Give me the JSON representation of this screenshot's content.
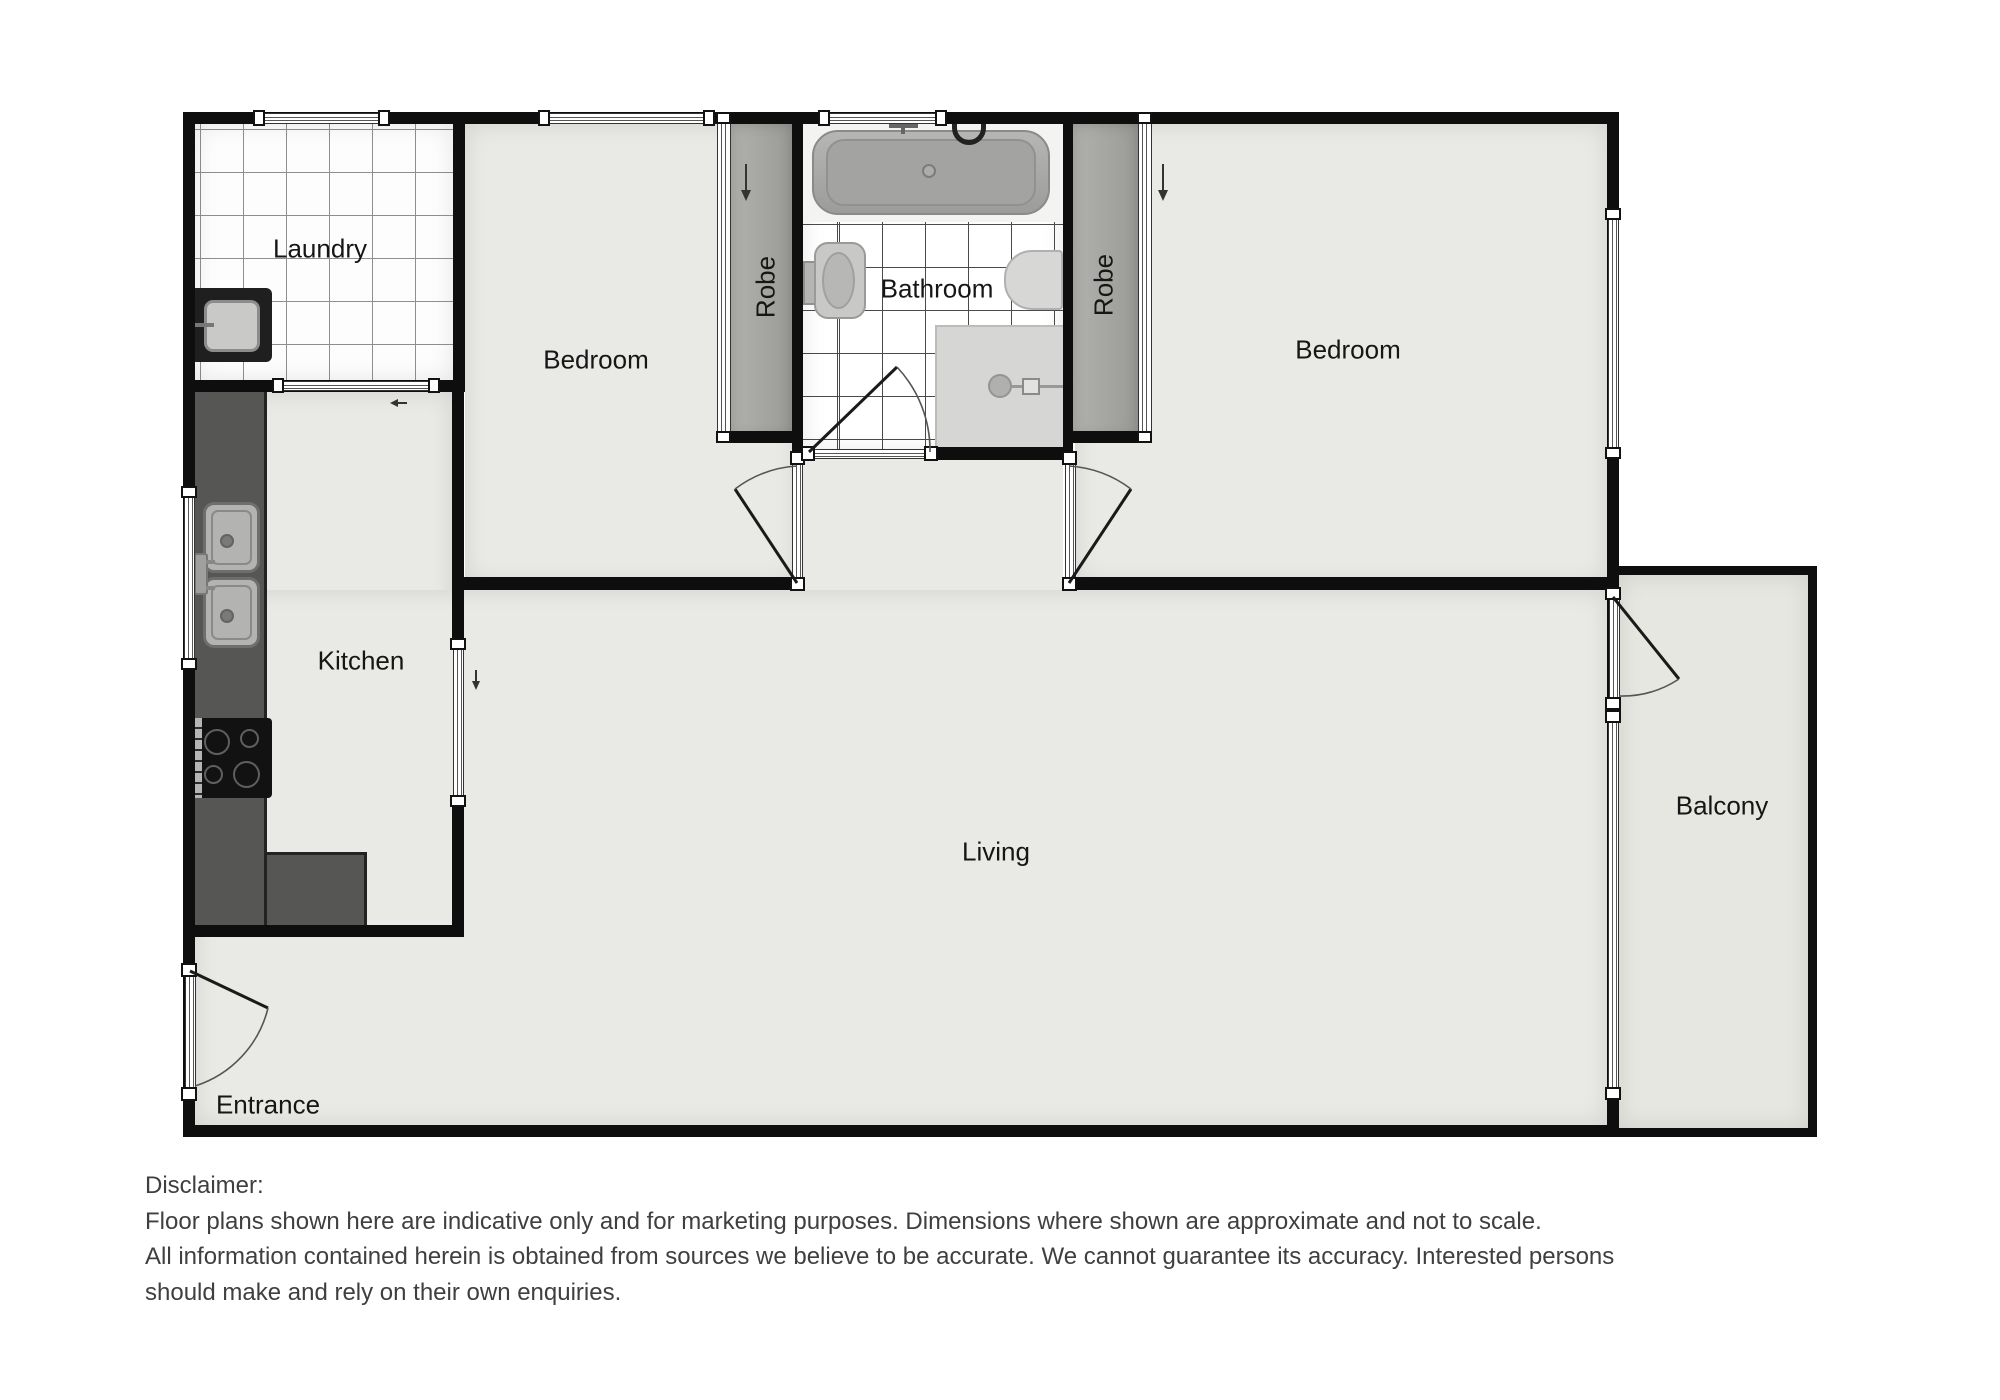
{
  "rooms": {
    "laundry": {
      "label": "Laundry"
    },
    "bedroom1": {
      "label": "Bedroom"
    },
    "robe1": {
      "label": "Robe"
    },
    "bathroom": {
      "label": "Bathroom"
    },
    "robe2": {
      "label": "Robe"
    },
    "bedroom2": {
      "label": "Bedroom"
    },
    "kitchen": {
      "label": "Kitchen"
    },
    "living": {
      "label": "Living"
    },
    "balcony": {
      "label": "Balcony"
    },
    "entrance": {
      "label": "Entrance"
    }
  },
  "icons": {
    "robe1-slide-arrow": "↓",
    "robe2-slide-arrow": "↓",
    "kitchen-door-slide-arrow": "↓",
    "laundry-door-slide-arrow": "←"
  },
  "colors": {
    "wall": "#0e0e0e",
    "floor": "#e9e9e5",
    "balcony_floor": "#e7e7e1",
    "robe_floor": "#a6a6a3",
    "kitchen_counter": "#565654",
    "laundry_tile_grid": "#8f8f8f",
    "bathroom_tile_grid": "#4a4a4a",
    "label_text": "#161616",
    "disclaimer_text": "#3f3f3f"
  },
  "disclaimer": {
    "lines": [
      "Disclaimer:",
      "Floor plans shown here are indicative only and for marketing purposes. Dimensions where shown are approximate and not to scale.",
      "All information contained herein is obtained from sources we believe to be accurate. We cannot guarantee its accuracy. Interested persons",
      "should make and rely on their own enquiries."
    ]
  }
}
